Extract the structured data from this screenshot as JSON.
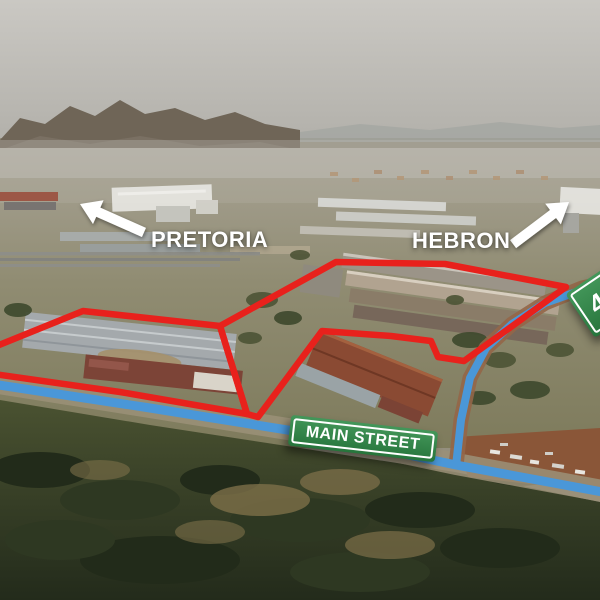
{
  "annotations": {
    "destination_left": "PRETORIA",
    "destination_right": "HEBRON"
  },
  "signs": {
    "street_sign": "MAIN STREET",
    "route_sign": "47"
  },
  "icons": {
    "left_arrow": "arrow-up-left",
    "right_arrow": "arrow-up-right"
  },
  "colors": {
    "boundary_red": "#e8211c",
    "route_blue": "#4a97d8",
    "sign_green": "#2e8b47",
    "sign_border": "#ffffff",
    "annotation_white": "#ffffff"
  }
}
